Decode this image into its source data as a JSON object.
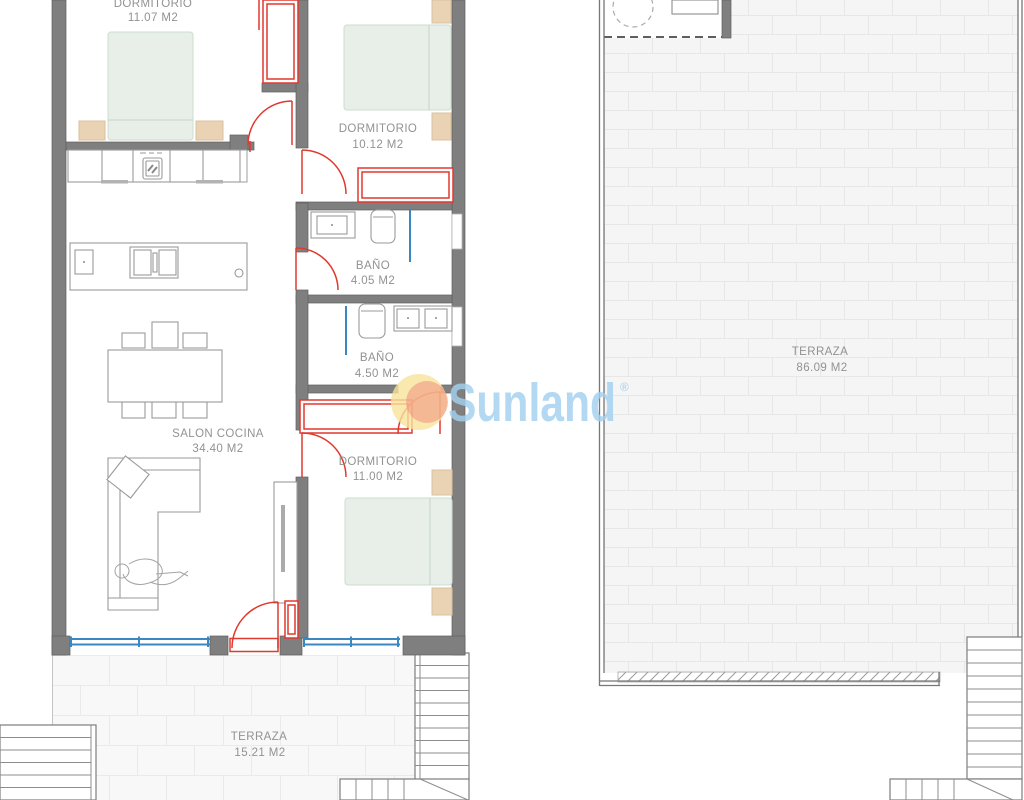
{
  "plan": {
    "type": "floor-plan",
    "units": "M2"
  },
  "rooms": [
    {
      "name": "DORMITORIO",
      "area": "11.07 M2"
    },
    {
      "name": "DORMITORIO",
      "area": "10.12 M2"
    },
    {
      "name": "BAÑO",
      "area": "4.05 M2"
    },
    {
      "name": "BAÑO",
      "area": "4.50 M2"
    },
    {
      "name": "SALON COCINA",
      "area": "34.40 M2"
    },
    {
      "name": "DORMITORIO",
      "area": "11.00 M2"
    },
    {
      "name": "TERRAZA",
      "area": "15.21 M2"
    },
    {
      "name": "TERRAZA",
      "area": "86.09 M2"
    }
  ],
  "watermark": {
    "brand": "Sunland",
    "registered": "®"
  },
  "colors": {
    "wall": "#7f7f7f",
    "door_red": "#e0392e",
    "window_blue": "#3a87c2",
    "bed_green": "#e7efe8",
    "nightstand_tan": "#e9d3b4",
    "label_gray": "#929292",
    "brand_blue": "#a3d0ee",
    "sun_yellow": "#f8e49b",
    "sun_salmon": "#f0907e",
    "tile_bg": "#f8f8f8",
    "brick_bg": "#f5f5f5"
  }
}
